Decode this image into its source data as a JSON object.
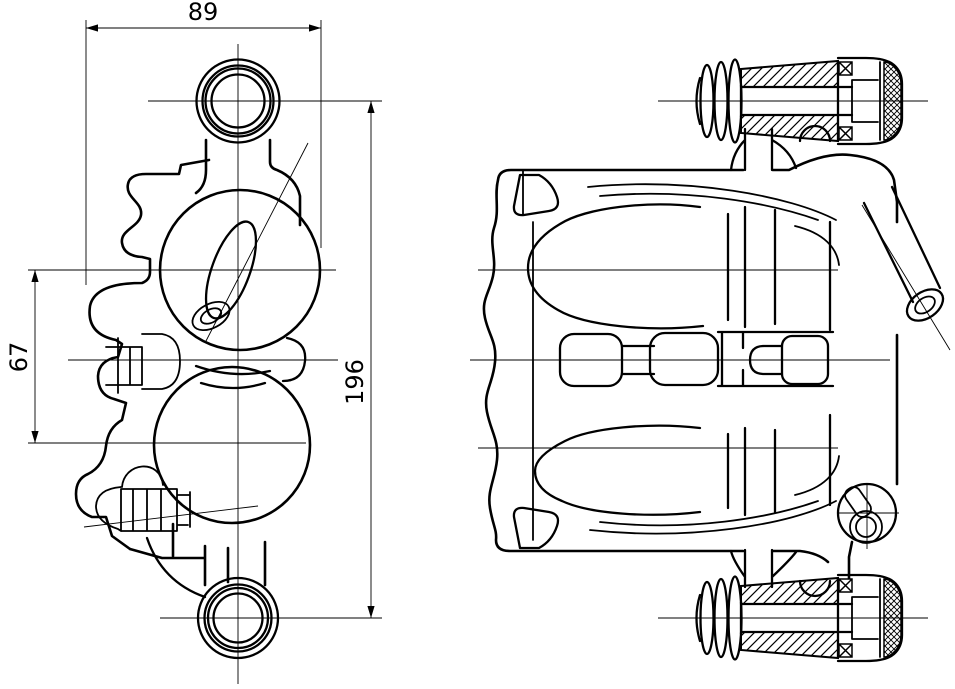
{
  "drawing": {
    "background": "#ffffff",
    "stroke_color": "#000000",
    "type": "technical-drawing",
    "subject": "brake caliper, two orthographic views",
    "views": {
      "side": {
        "name": "caliper side view"
      },
      "front": {
        "name": "caliper front view"
      }
    },
    "dimensions": {
      "width": {
        "label": "89",
        "orientation": "horizontal"
      },
      "offset": {
        "label": "67",
        "orientation": "vertical"
      },
      "span": {
        "label": "196",
        "orientation": "vertical"
      }
    }
  }
}
